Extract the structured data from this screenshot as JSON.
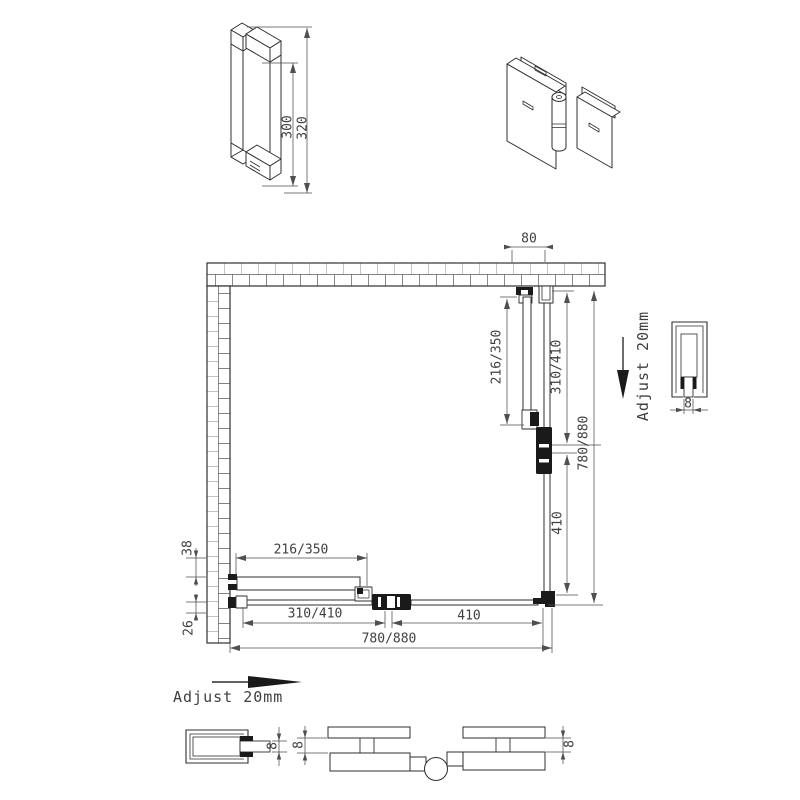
{
  "colors": {
    "background": "#ffffff",
    "line": "#2f2f2f",
    "dim_line": "#4f4f4f",
    "text": "#3f3f3f"
  },
  "handle_view": {
    "dim_length": "300",
    "dim_overall": "320"
  },
  "plan": {
    "top_offset": "80",
    "right": {
      "door_panel": "216/350",
      "wall_to_hinge": "310/410",
      "hinge_to_corner": "410",
      "overall": "780/880"
    },
    "bottom": {
      "door_panel": "216/350",
      "wall_to_hinge": "310/410",
      "hinge_to_corner": "410",
      "overall": "780/880"
    },
    "left": {
      "upper": "38",
      "lower": "26"
    }
  },
  "notes": {
    "adjust_right": "Adjust 20mm",
    "adjust_bottom": "Adjust 20mm"
  },
  "profiles": {
    "glass_thickness": "8"
  }
}
